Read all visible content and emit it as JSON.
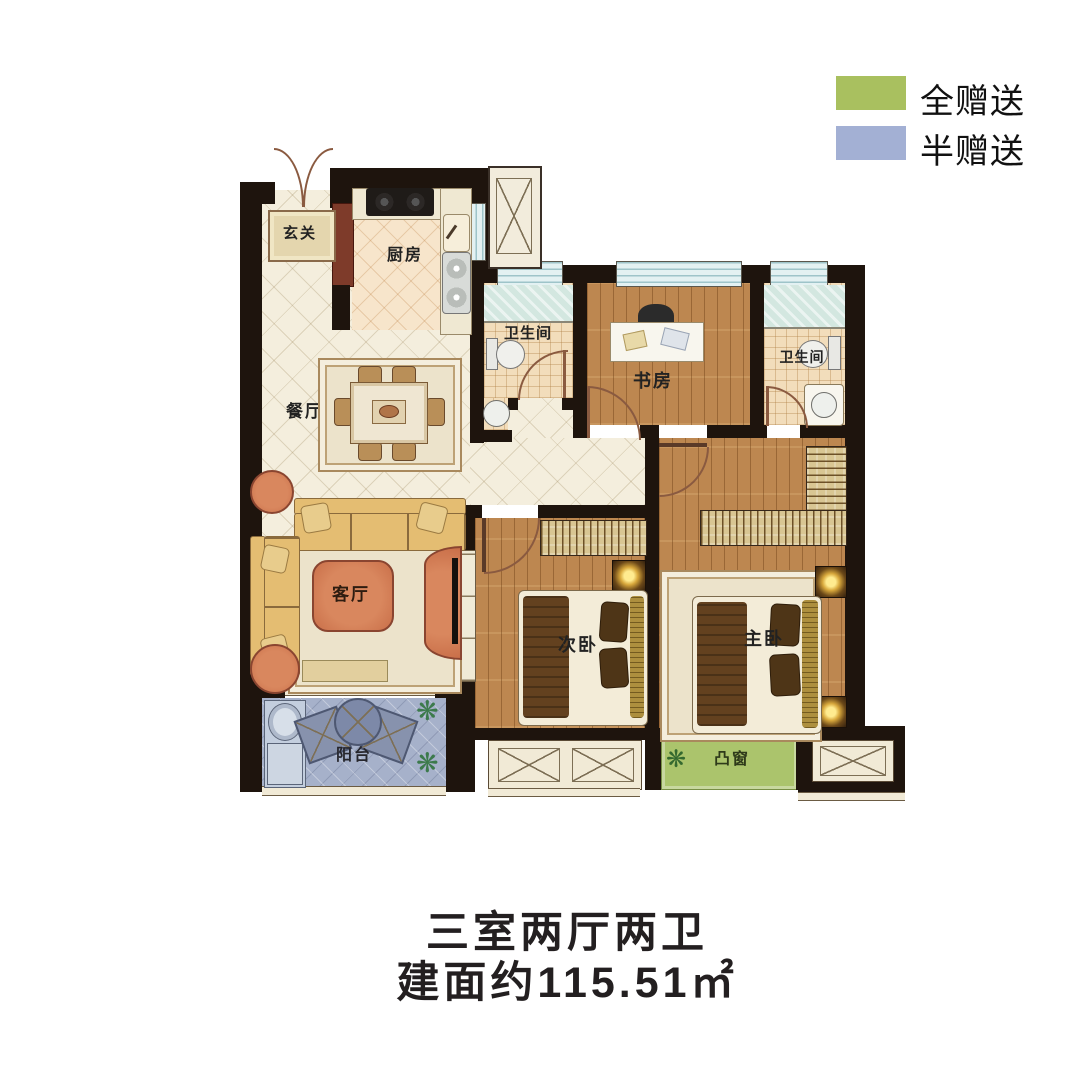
{
  "legend": {
    "items": [
      {
        "name": "full-gift",
        "label": "全赠送",
        "color": "#a9c05f"
      },
      {
        "name": "half-gift",
        "label": "半赠送",
        "color": "#a3b0d4"
      }
    ]
  },
  "rooms": {
    "entry": "玄关",
    "kitchen": "厨房",
    "dining": "餐厅",
    "living": "客厅",
    "bath1": "卫生间",
    "study": "书房",
    "bath2": "卫生间",
    "bedroom2": "次卧",
    "master": "主卧",
    "balcony": "阳台",
    "bay_window": "凸窗"
  },
  "title": {
    "line1": "三室两厅两卫",
    "line2": "建面约115.51㎡"
  },
  "icons": {
    "plant": "❋"
  },
  "colors": {
    "bay_window_fill": "#abc46c",
    "balcony_fill": "#a6b1ca"
  }
}
